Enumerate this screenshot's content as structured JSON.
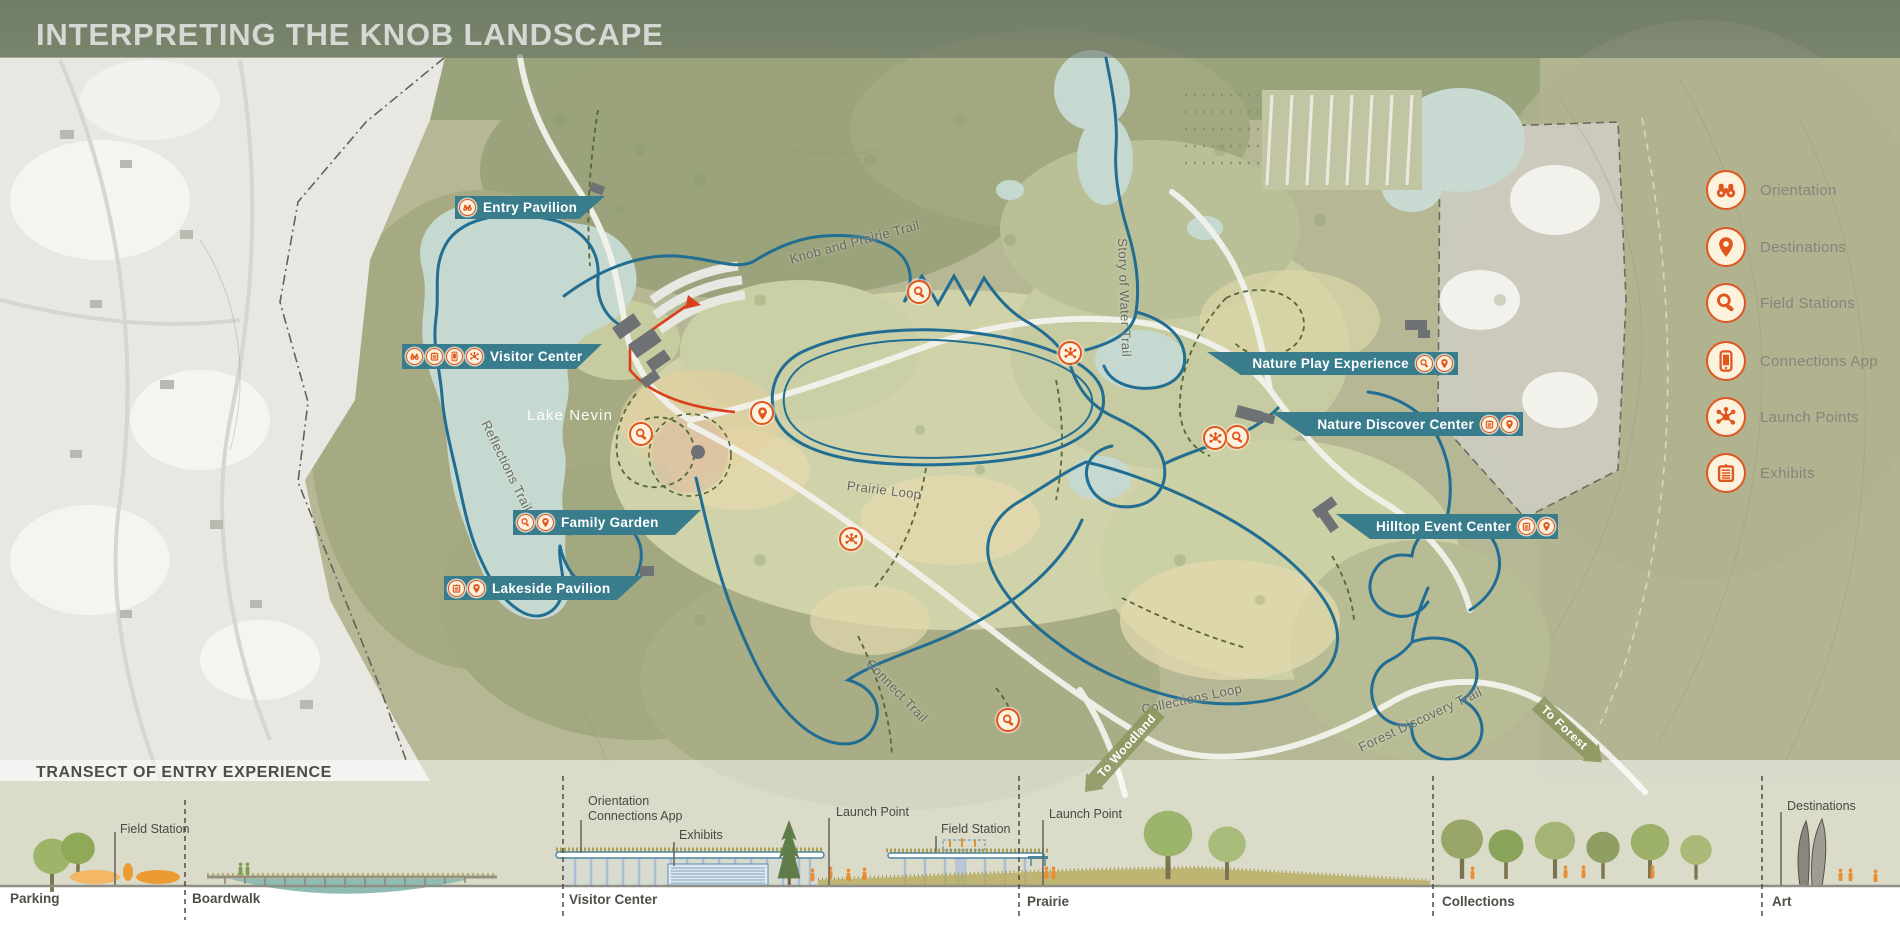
{
  "title": "INTERPRETING THE KNOB LANDSCAPE",
  "map": {
    "lake_label": "Lake Nevin",
    "trails": {
      "reflections": "Reflections Trail",
      "knob_prairie": "Knob and Prairie Trail",
      "story_water": "Story of Water Trail",
      "prairie_loop": "Prairie Loop",
      "connect": "Connect Trail",
      "collections_loop": "Collections Loop",
      "forest_discovery": "Forest Discovery Trail"
    },
    "arrows": {
      "woodland": "To Woodland",
      "forest": "To Forest"
    },
    "banners": [
      {
        "label": "Entry Pavilion",
        "icons": [
          "orientation"
        ],
        "icon_side": "left"
      },
      {
        "label": "Visitor Center",
        "icons": [
          "orientation",
          "exhibits",
          "connections-app",
          "launch-points"
        ],
        "icon_side": "left"
      },
      {
        "label": "Family Garden",
        "icons": [
          "field-stations",
          "destinations"
        ],
        "icon_side": "left"
      },
      {
        "label": "Lakeside Pavilion",
        "icons": [
          "exhibits",
          "destinations"
        ],
        "icon_side": "left"
      },
      {
        "label": "Nature Play Experience",
        "icons": [
          "field-stations",
          "destinations"
        ],
        "icon_side": "right"
      },
      {
        "label": "Nature Discover Center",
        "icons": [
          "exhibits",
          "destinations"
        ],
        "icon_side": "right"
      },
      {
        "label": "Hilltop Event Center",
        "icons": [
          "exhibits",
          "destinations"
        ],
        "icon_side": "right"
      }
    ],
    "point_icons": [
      {
        "icon": "destinations"
      },
      {
        "icon": "field-stations"
      },
      {
        "icon": "field-stations"
      },
      {
        "icon": "field-stations"
      },
      {
        "icon": "field-stations"
      },
      {
        "icon": "launch-points"
      },
      {
        "icon": "launch-points"
      },
      {
        "icon": "launch-points"
      }
    ]
  },
  "legend": {
    "items": [
      {
        "label": "Orientation",
        "icon": "orientation"
      },
      {
        "label": "Destinations",
        "icon": "destinations"
      },
      {
        "label": "Field Stations",
        "icon": "field-stations"
      },
      {
        "label": "Connections App",
        "icon": "connections-app"
      },
      {
        "label": "Launch Points",
        "icon": "launch-points"
      },
      {
        "label": "Exhibits",
        "icon": "exhibits"
      }
    ]
  },
  "transect": {
    "title": "TRANSECT OF ENTRY EXPERIENCE",
    "sections": [
      {
        "label": "Parking"
      },
      {
        "label": "Boardwalk"
      },
      {
        "label": "Visitor Center"
      },
      {
        "label": "Prairie"
      },
      {
        "label": "Collections"
      },
      {
        "label": "Art"
      }
    ],
    "callouts": [
      {
        "label": "Field Station"
      },
      {
        "label": "Orientation"
      },
      {
        "label": "Connections App"
      },
      {
        "label": "Exhibits"
      },
      {
        "label": "Launch Point"
      },
      {
        "label": "Field Station"
      },
      {
        "label": "Launch Point"
      },
      {
        "label": "Destinations"
      }
    ]
  },
  "colors": {
    "banner_teal": "#397d8c",
    "icon_orange": "#e0561f",
    "icon_cream": "#fdf2dd",
    "trail_blue": "#226d92",
    "entry_path_red": "#da3f1c",
    "water": "#c6d9d0"
  }
}
